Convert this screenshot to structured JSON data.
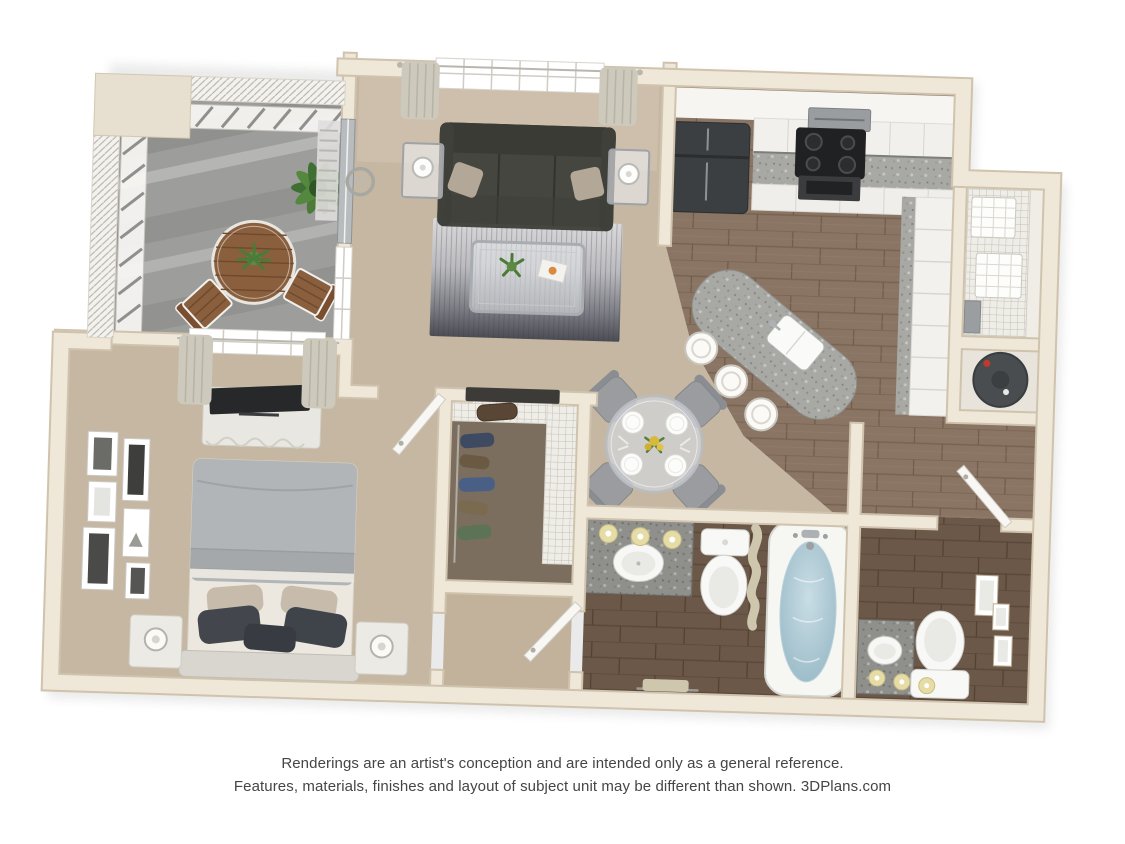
{
  "page": {
    "background": "#ffffff",
    "width": 1125,
    "height": 844
  },
  "artwork": {
    "kind": "3d-apartment-floor-plan-rendering",
    "view": "top-down"
  },
  "disclaimer": {
    "line1": "Renderings are an artist's conception and are intended only as a general reference.",
    "line2": "Features, materials, finishes and layout of subject unit may be different than shown. 3DPlans.com",
    "brand": "3DPlans.com",
    "text_color": "#454545"
  },
  "palette": {
    "wall": "#EFE7D8",
    "wall_edge": "#CFC3AD",
    "carpet": "#C6B7A2",
    "closet_carpet": "#7C6E5E",
    "wood_light": "#8A7464",
    "wood_dark": "#6B5848",
    "balcony_concrete": "#9D9D9B",
    "sofa": "#45463F",
    "rug_light": "#D9D9DB",
    "rug_dark": "#4B4C54",
    "granite": "#A8A8A4",
    "granite_dark": "#8A8A88",
    "cabinet_white": "#F1F0EC",
    "appliance_black": "#1F2123",
    "stainless": "#9A9DA0",
    "bed_duvet": "#B2B5B7",
    "bed_sheet": "#ECE8E0",
    "pillow_dark": "#43474D",
    "tub_water": "#9FBECB",
    "vanity_light_shade": "#E6DCA6",
    "plant_green": "#4C7A38",
    "patio_wood": "#8A5F3E",
    "door_white": "#F8F7F4",
    "screen_hatch": "#B5B1A7"
  },
  "rooms": [
    {
      "id": "balcony",
      "furniture": [
        "bistro-table",
        "table-plant",
        "patio-chair-left",
        "patio-chair-right",
        "potted-fern",
        "screen-walls",
        "privacy-railing"
      ]
    },
    {
      "id": "living-room",
      "furniture": [
        "sofa",
        "throw-pillows",
        "area-rug",
        "coffee-table",
        "coffee-table-plant",
        "magazine",
        "end-table-left",
        "end-table-right",
        "table-lamps",
        "picture-window",
        "curtains",
        "wall-wreath",
        "side-window",
        "sliding-door"
      ]
    },
    {
      "id": "kitchen",
      "furniture": [
        "refrigerator",
        "microwave",
        "range",
        "upper-cabinets",
        "granite-counter",
        "base-cabinets",
        "drawer-bank",
        "granite-island",
        "island-sink",
        "bar-stools"
      ]
    },
    {
      "id": "dining-area",
      "furniture": [
        "round-glass-table",
        "dining-chairs",
        "place-settings",
        "centerpiece"
      ]
    },
    {
      "id": "pantry",
      "furniture": [
        "wire-shelving",
        "storage-baskets"
      ]
    },
    {
      "id": "utility-closet",
      "furniture": [
        "water-heater"
      ]
    },
    {
      "id": "walk-in-closet",
      "furniture": [
        "wire-shelf",
        "hanging-clothes",
        "duffel-bag"
      ]
    },
    {
      "id": "bedroom",
      "furniture": [
        "bed",
        "headboard",
        "pillows",
        "nightstand-left",
        "nightstand-right",
        "table-lamps",
        "dresser",
        "tv",
        "window",
        "curtains",
        "gallery-frames"
      ]
    },
    {
      "id": "hallway",
      "furniture": [
        "bathroom-door"
      ]
    },
    {
      "id": "main-bathroom",
      "furniture": [
        "granite-vanity",
        "sink",
        "vanity-lights",
        "toilet",
        "shower-curtain",
        "bathtub",
        "towel-bar"
      ]
    },
    {
      "id": "second-bathroom",
      "furniture": [
        "granite-vanity",
        "sink",
        "vanity-lights",
        "toilet",
        "wall-frames"
      ]
    }
  ]
}
